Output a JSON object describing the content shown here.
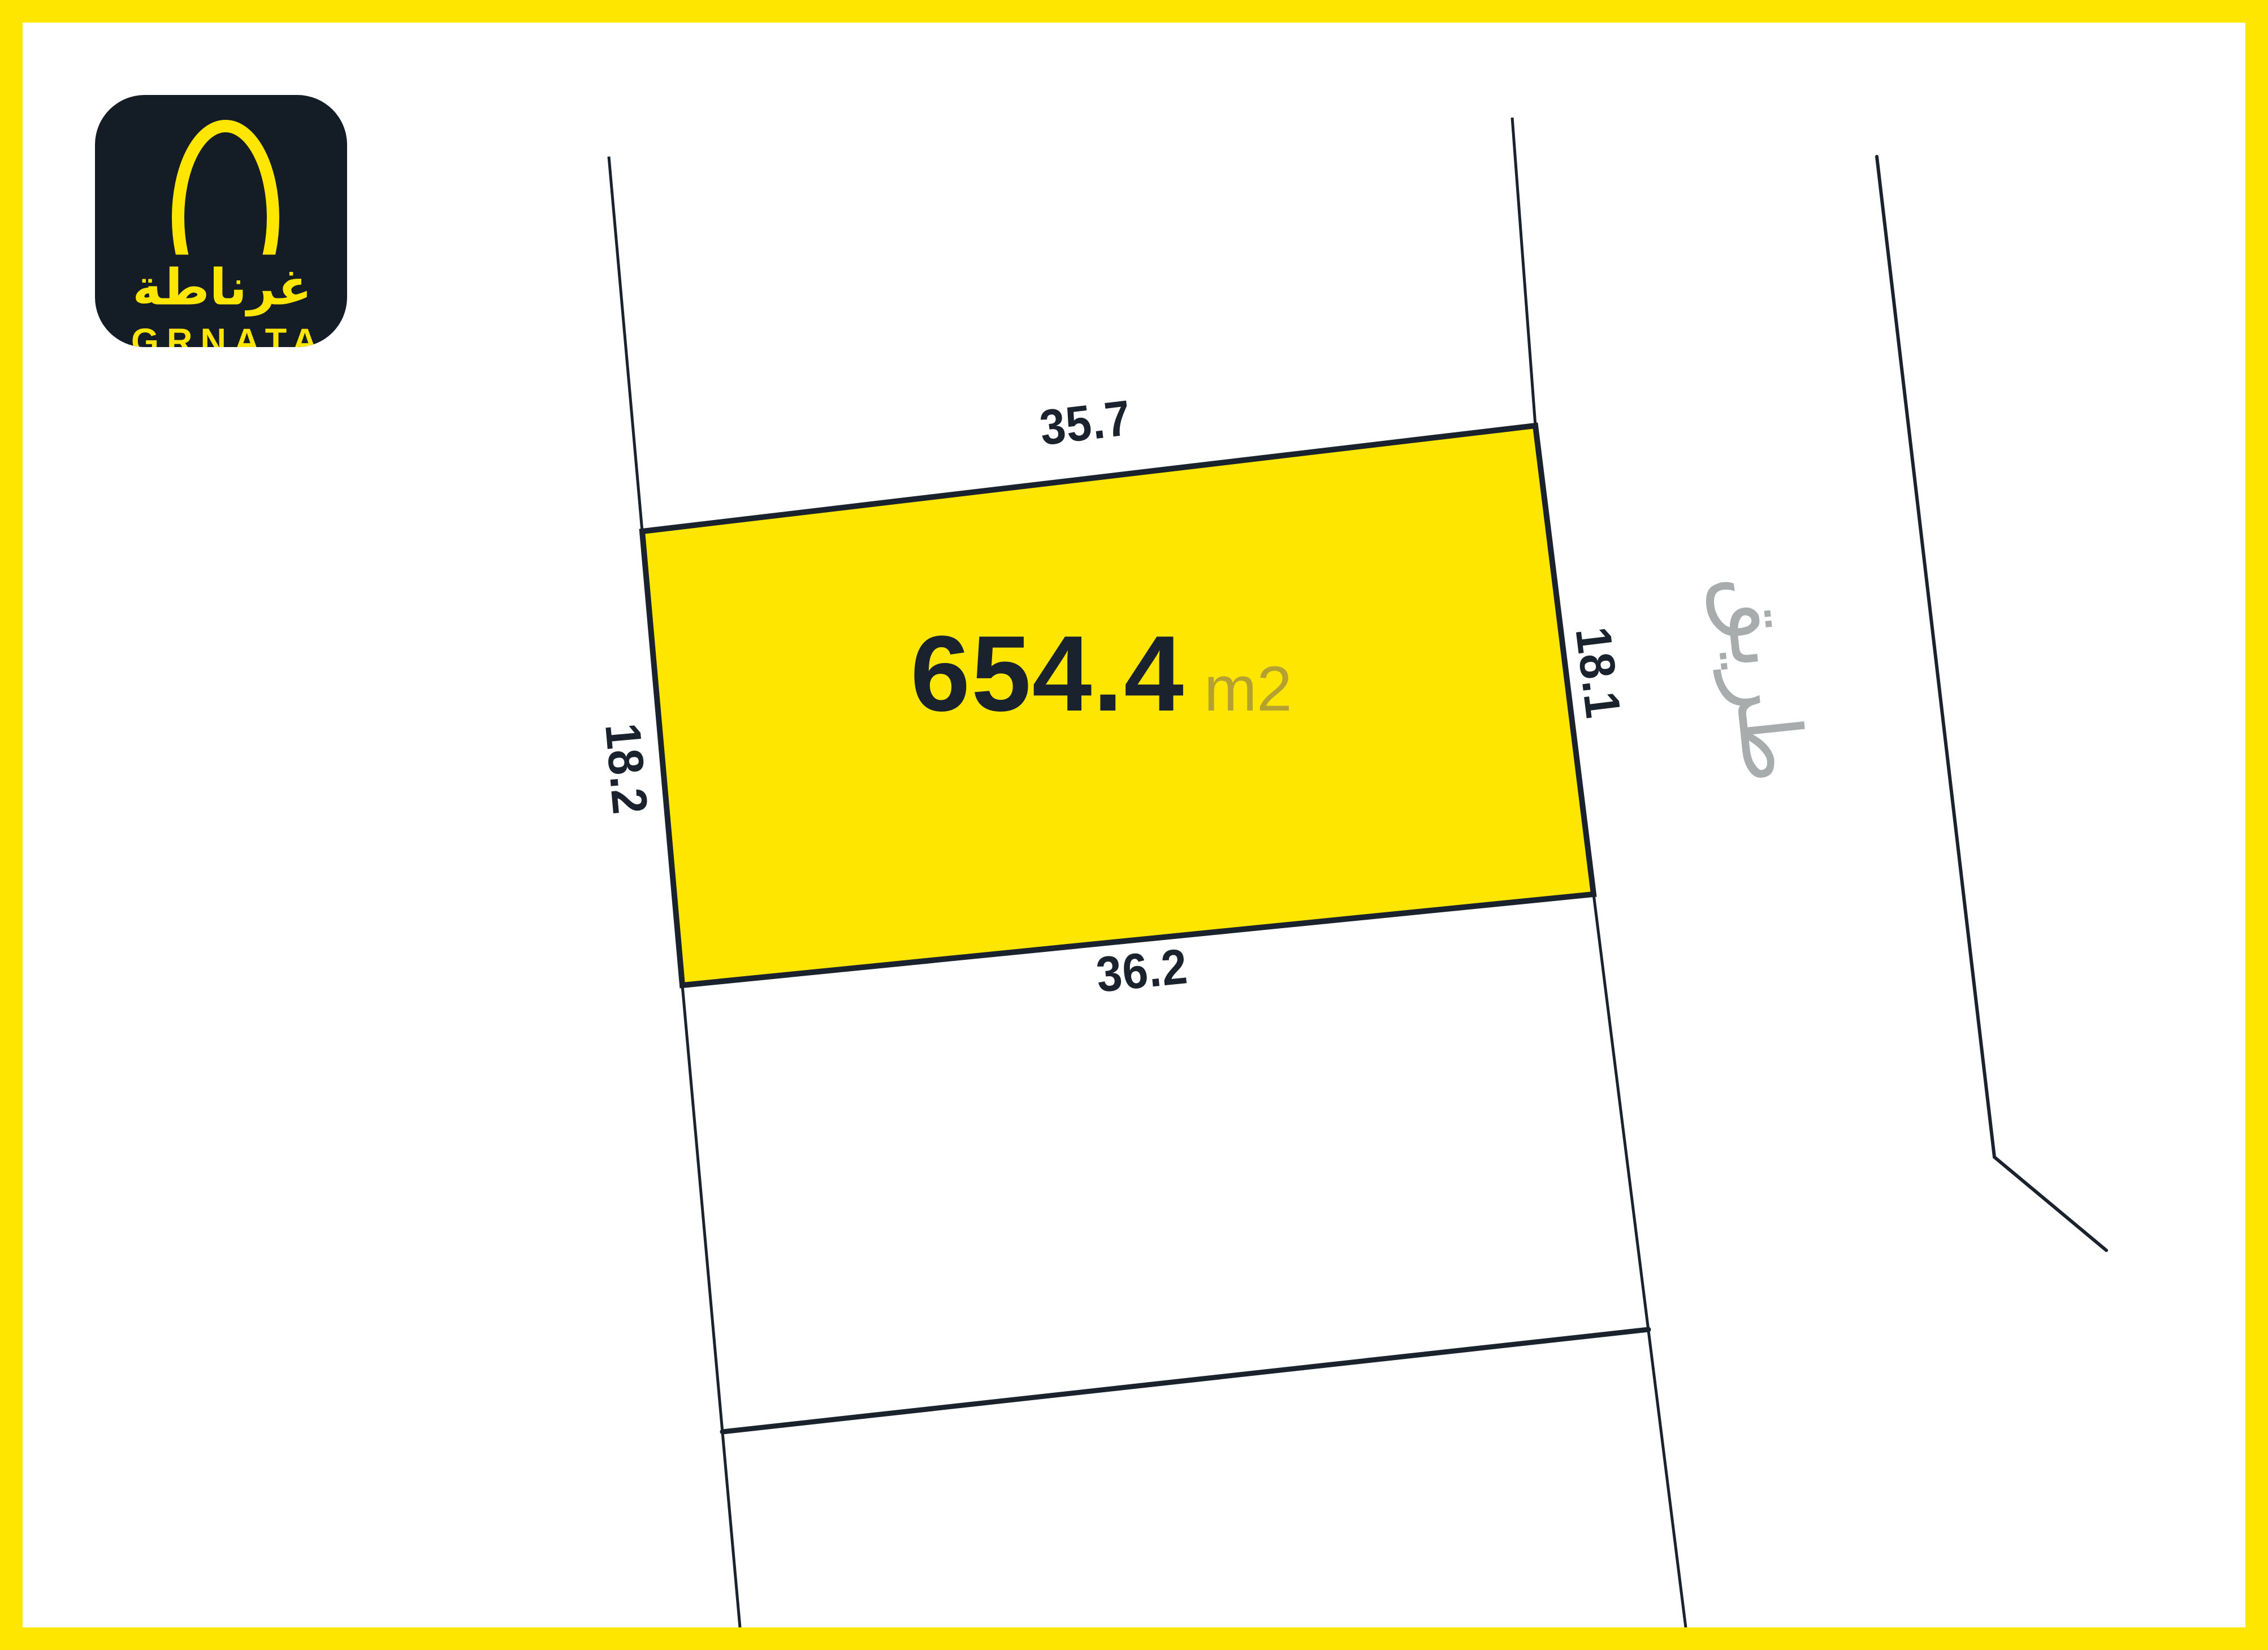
{
  "colors": {
    "yellow": "#FFE600",
    "navy": "#1A222E",
    "line": "#1A222E",
    "gray_road": "#A8ACAD",
    "olive_unit": "#B5A032",
    "logo_bg": "#141C25",
    "white": "#FFFFFF"
  },
  "logo": {
    "arabic": "غرناطة",
    "latin": "GRNATA"
  },
  "parcel": {
    "area_value": "654.4",
    "area_unit": "m2",
    "dimensions": {
      "top": "35.7",
      "bottom": "36.2",
      "left": "18.2",
      "right": "18.1"
    }
  },
  "road": {
    "label": "طريق"
  }
}
